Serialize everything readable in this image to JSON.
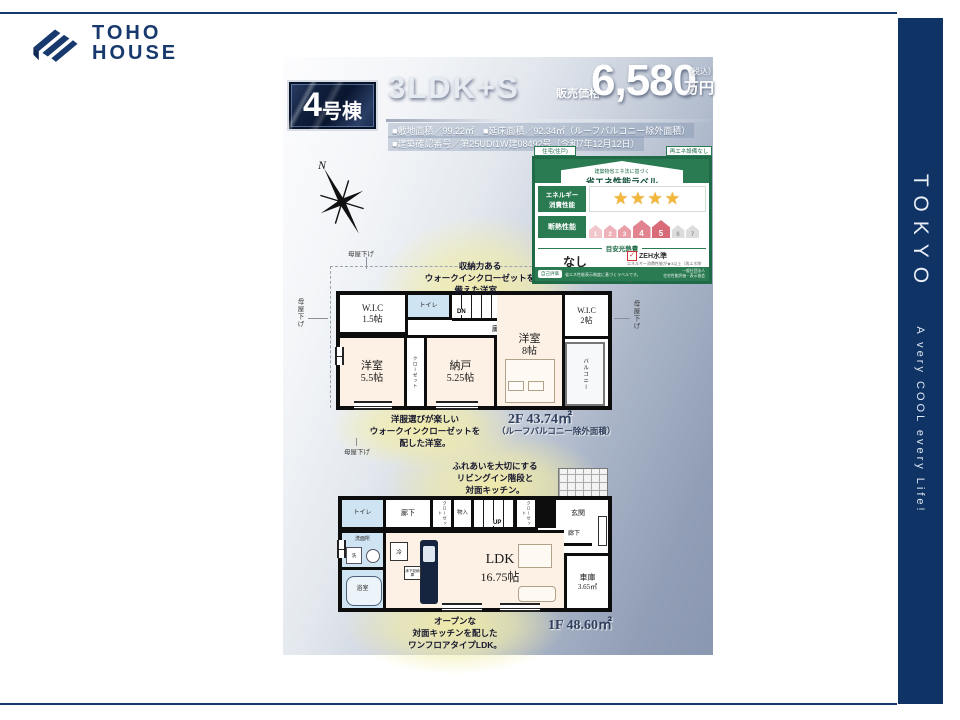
{
  "brand": {
    "line1": "TOHO",
    "line2": "HOUSE"
  },
  "sidebar": {
    "title": "TOKYO",
    "tagline": "A very COOL every Life!"
  },
  "header": {
    "unit_no": "4",
    "unit_suffix": "号棟",
    "plan_type": "3LDK+S",
    "price_label": "販売価格",
    "price_value": "6,580",
    "price_tax": "（税込）",
    "price_unit": "万円",
    "spec1": "■敷地面積／99.22㎡　■延床面積／92.34㎡（ルーフバルコニー除外面積）",
    "spec2": "■建築確認番号／第25UDI1W建08492号（令和7年12月12日）"
  },
  "compass": {
    "north": "N"
  },
  "energy_label": {
    "tab_left": "住宅(住戸)",
    "tab_right": "再エネ設備なし",
    "subtitle": "建築物省エネ法に基づく",
    "title": "省エネ性能ラベル",
    "energy_row_label_1": "エネルギー",
    "energy_row_label_2": "消費性能",
    "stars": "★★★★",
    "insulation_label": "断熱性能",
    "scale": [
      "1",
      "2",
      "3",
      "4",
      "5",
      "6",
      "7"
    ],
    "cost_header": "目安光熱費",
    "cost_value": "なし",
    "zeh_label": "ZEH水準",
    "zeh_note1": "エネルギー消費性能が★3以上（再エネ除く）かつ、",
    "zeh_note2": "断熱性能が等級5以上の場合に表示されます。",
    "footer_badge": "自己評価",
    "footer_left": "省エネ性能表示制度に基づくラベルです。",
    "footer_right1": "一般社団法人",
    "footer_right2": "住宅性能評価・表示協会"
  },
  "floor2": {
    "area_label": "2F 43.74㎡",
    "area_note": "（ルーフバルコニー除外面積）",
    "annotation_top": [
      "収納力ある",
      "ウォークインクローゼットを",
      "備えた洋室。"
    ],
    "annotation_bottom": [
      "洋服選びが楽しい",
      "ウォークインクローゼットを",
      "配した洋室。"
    ],
    "moya": "母屋下げ",
    "rooms": {
      "wic15_name": "W.I.C",
      "wic15_size": "1.5帖",
      "toilet": "トイレ",
      "stairs_dn": "DN",
      "hall": "廊下",
      "yoshitsu55_name": "洋室",
      "yoshitsu55_size": "5.5帖",
      "closet": "クローゼット",
      "nando_name": "納戸",
      "nando_size": "5.25帖",
      "yoshitsu8_name": "洋室",
      "yoshitsu8_size": "8帖",
      "wic2_name": "W.I.C",
      "wic2_size": "2帖",
      "balcony": "バルコニー"
    }
  },
  "floor1": {
    "area_label": "1F 48.60㎡",
    "annotation_top": [
      "ふれあいを大切にする",
      "リビングイン階段と",
      "対面キッチン。"
    ],
    "annotation_bottom": [
      "オープンな",
      "対面キッチンを配した",
      "ワンフロアタイプLDK。"
    ],
    "rooms": {
      "toilet": "トイレ",
      "hall": "廊下",
      "closet": "クローゼット",
      "mono": "物入",
      "stairs_up": "UP",
      "genkan": "玄関",
      "senmen": "洗面所",
      "laundry": "洗",
      "bath": "浴室",
      "ldk_name": "LDK",
      "ldk_size": "16.75帖",
      "fridge": "冷",
      "floor_storage": "床下収納庫",
      "garage_name": "車庫",
      "garage_size": "3.65㎡"
    }
  },
  "colors": {
    "navy": "#0e3364",
    "green": "#2a7a52",
    "accent_yellow": "#f2eca9"
  }
}
